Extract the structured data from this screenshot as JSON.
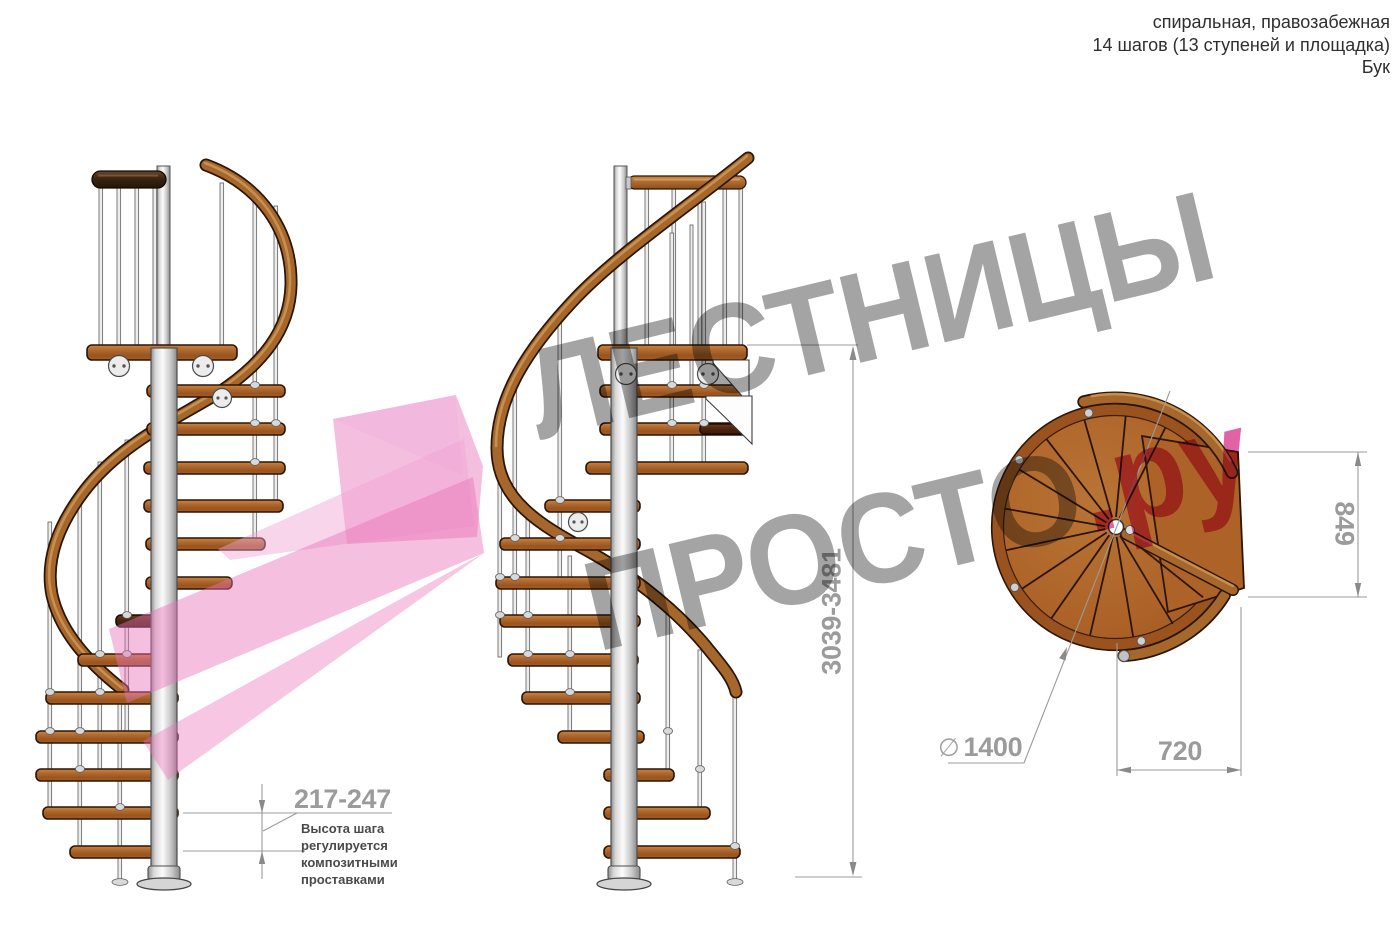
{
  "title_block": {
    "line1": "спиральная, правозабежная",
    "line2": "14 шагов (13 ступеней и площадка)",
    "line3": "Бук"
  },
  "watermark": {
    "word1": "ЛЕСТНИЦЫ",
    "word2": "ПРОСТО",
    "suffix": ".ру"
  },
  "dimensions": {
    "step_height": {
      "value": "217-247",
      "note": [
        "Высота шага",
        "регулируется",
        "композитными",
        "проставками"
      ]
    },
    "total_height": {
      "value": "3039-3481"
    },
    "plan_depth": {
      "value": "849"
    },
    "plan_width": {
      "value": "720"
    },
    "diameter": {
      "symbol": "∅",
      "value": "1400"
    }
  },
  "colors": {
    "wood": "#ad6328",
    "wood_dark": "#4a2410",
    "steel": "#d9d9d9",
    "dimension_gray": "#9b9b9b",
    "note_text": "#4a4a4a",
    "watermark_gray": "#9d9d9d",
    "watermark_pink": "#e0579e",
    "arrow_pink": "#ea7fc0"
  }
}
